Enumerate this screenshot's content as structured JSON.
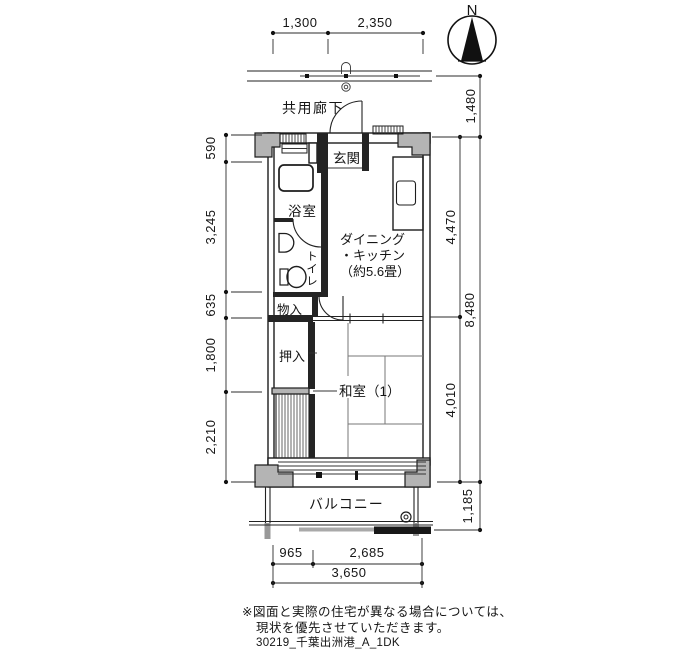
{
  "compass": {
    "north_label": "N"
  },
  "rooms": {
    "common_corridor": "共用廊下",
    "entrance": "玄関",
    "bathroom": "浴室",
    "toilet": "トイレ",
    "storage": "物入",
    "closet": "押入",
    "dining_kitchen_line1": "ダイニング",
    "dining_kitchen_line2": "・キッチン",
    "dining_kitchen_line3": "（約5.6畳）",
    "japanese_room": "和室（1）",
    "balcony": "バルコニー"
  },
  "dimensions": {
    "top": [
      "1,300",
      "2,350"
    ],
    "left": [
      "590",
      "3,245",
      "635",
      "1,800",
      "2,210"
    ],
    "right": [
      "1,480",
      "4,470",
      "8,480",
      "4,010",
      "1,185"
    ],
    "bottom": [
      "965",
      "2,685",
      "3,650"
    ]
  },
  "notes": {
    "disclaimer_line1": "※図面と実際の住宅が異なる場合については、",
    "disclaimer_line2": "現状を優先させていただきます。",
    "drawing_code": "30219_千葉出洲港_A_1DK"
  },
  "colors": {
    "line": "#1d1d1d",
    "wall_fill": "#b4b4b4",
    "background": "#ffffff"
  }
}
